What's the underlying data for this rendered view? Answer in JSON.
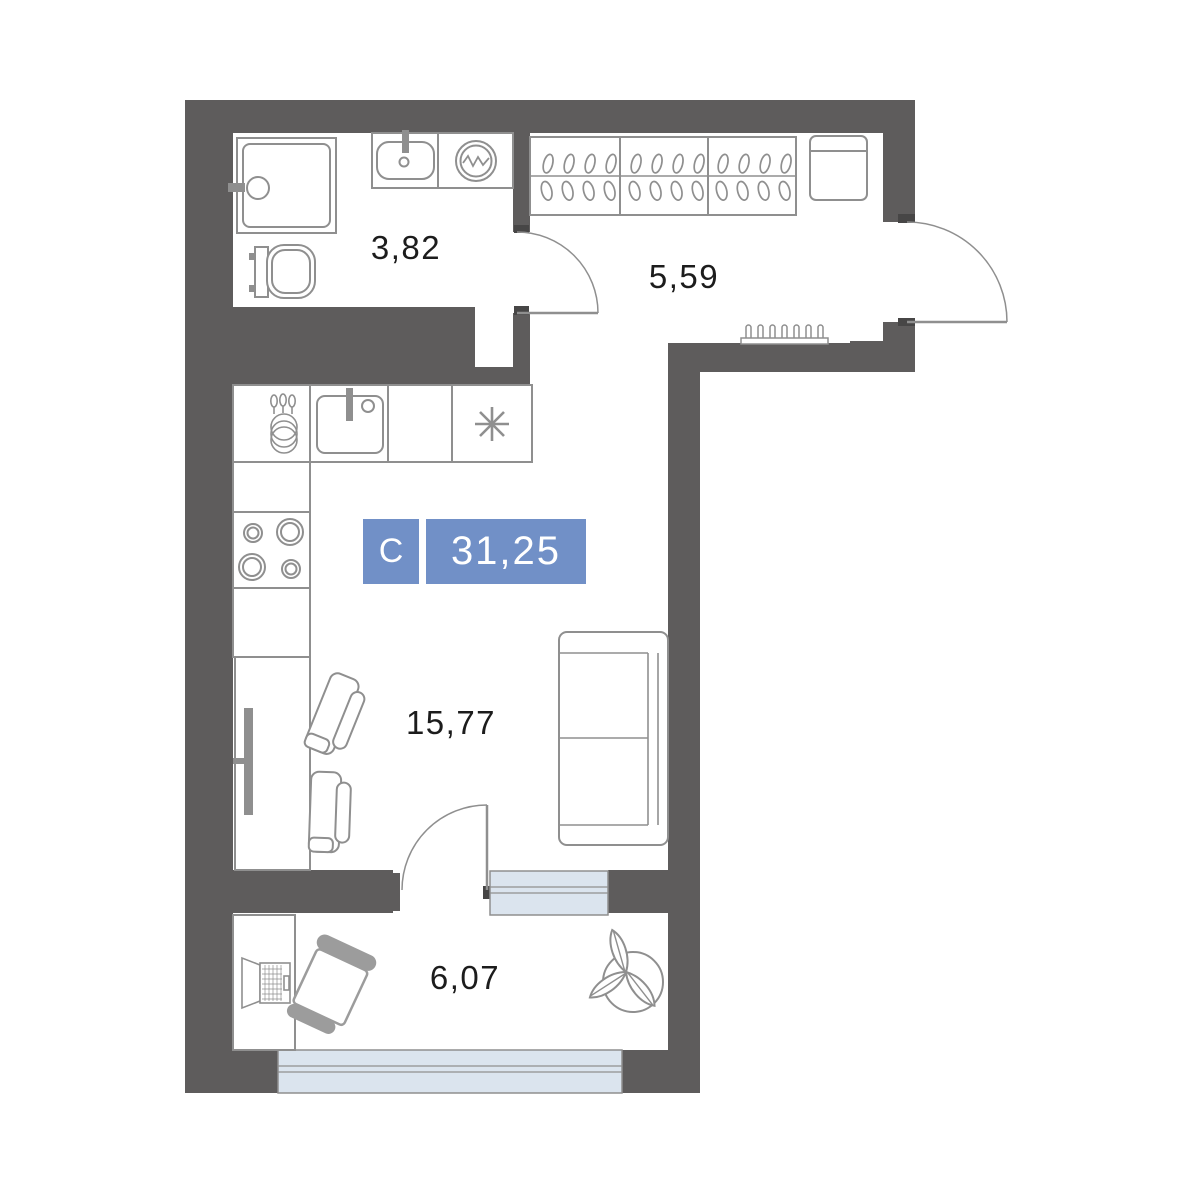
{
  "title": "studio-apartment-floor-plan",
  "badge": {
    "type_label": "С",
    "total_area": "31,25"
  },
  "rooms": {
    "bathroom": {
      "area": "3,82"
    },
    "hallway": {
      "area": "5,59"
    },
    "living_kitchen": {
      "area": "15,77"
    },
    "balcony": {
      "area": "6,07"
    }
  },
  "colors": {
    "wall": "#5e5c5c",
    "jamb": "#474646",
    "outline": "#8f8f8f",
    "window_fill": "#dbe4ee",
    "badge_blue": "#7190c7",
    "label_text": "#1c1c1c",
    "chair_gray": "#9c9c9c"
  },
  "icons": {
    "shower-icon": "square-with-drain-circle",
    "toilet-icon": "tank-and-bowl",
    "bath-sink-icon": "rounded-basin-with-tap",
    "washing-machine-icon": "double-circle-with-wave",
    "wardrobe-icon": "three-sections-with-hangers",
    "hallway-cabinet-icon": "rounded-box",
    "radiator-icon": "finned-heater",
    "kitchen-sink-icon": "square-basin-with-tap",
    "fridge-asterisk-icon": "eight-spoke-star",
    "stove-icon": "four-burners",
    "dish-rack-icon": "utensils-and-plates",
    "tv-icon": "wall-mounted-bar",
    "dining-table": "rectangle",
    "dining-chair-icon": "seat-with-back",
    "sofa-icon": "two-seat-sofa",
    "balcony-desk": "rectangle",
    "laptop-icon": "open-lid-and-keyboard",
    "office-chair-icon": "rotated-seat-with-gray-back",
    "plant-icon": "three-leaves-in-circle",
    "door-arc": "quarter-circle-swing"
  }
}
